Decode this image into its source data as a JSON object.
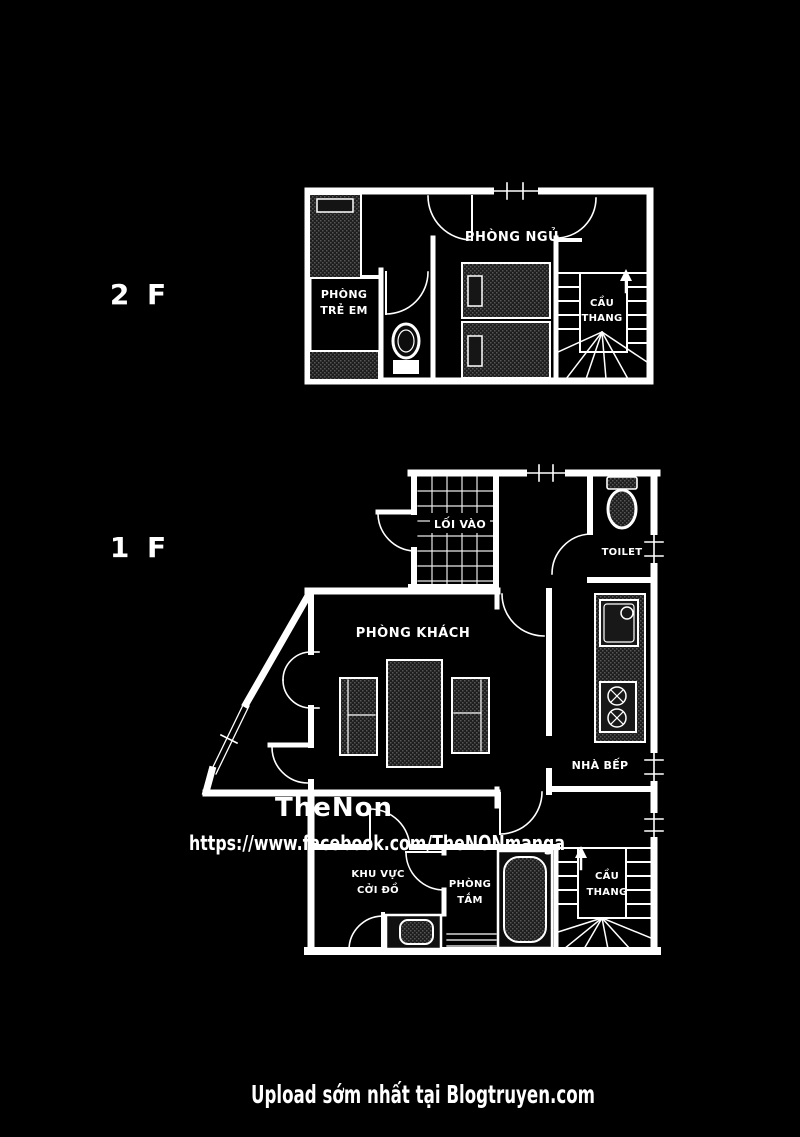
{
  "colors": {
    "background": "#000000",
    "walls": "#ffffff",
    "watermark_name": "#3d3d3d",
    "watermark_url": "#8f8f8f",
    "footer_text": "#b5b5b5"
  },
  "floor2": {
    "label": "2 F",
    "bedroom": "PHÒNG NGỦ",
    "kids_room_l1": "PHÒNG",
    "kids_room_l2": "TRẺ EM",
    "stairs_l1": "CẦU",
    "stairs_l2": "THANG"
  },
  "floor1": {
    "label": "1 F",
    "entrance": "LỐI VÀO",
    "toilet": "TOILET",
    "living": "PHÒNG KHÁCH",
    "kitchen": "NHÀ BẾP",
    "changing_l1": "KHU VỰC",
    "changing_l2": "CỞI ĐỒ",
    "bath_l1": "PHÒNG",
    "bath_l2": "TẮM",
    "stairs_l1": "CẦU",
    "stairs_l2": "THANG"
  },
  "watermark": {
    "name": "TheNon",
    "url": "https://www.facebook.com/TheNONmanga"
  },
  "footer": {
    "credit": "Upload sớm nhất tại Blogtruyen.com"
  }
}
